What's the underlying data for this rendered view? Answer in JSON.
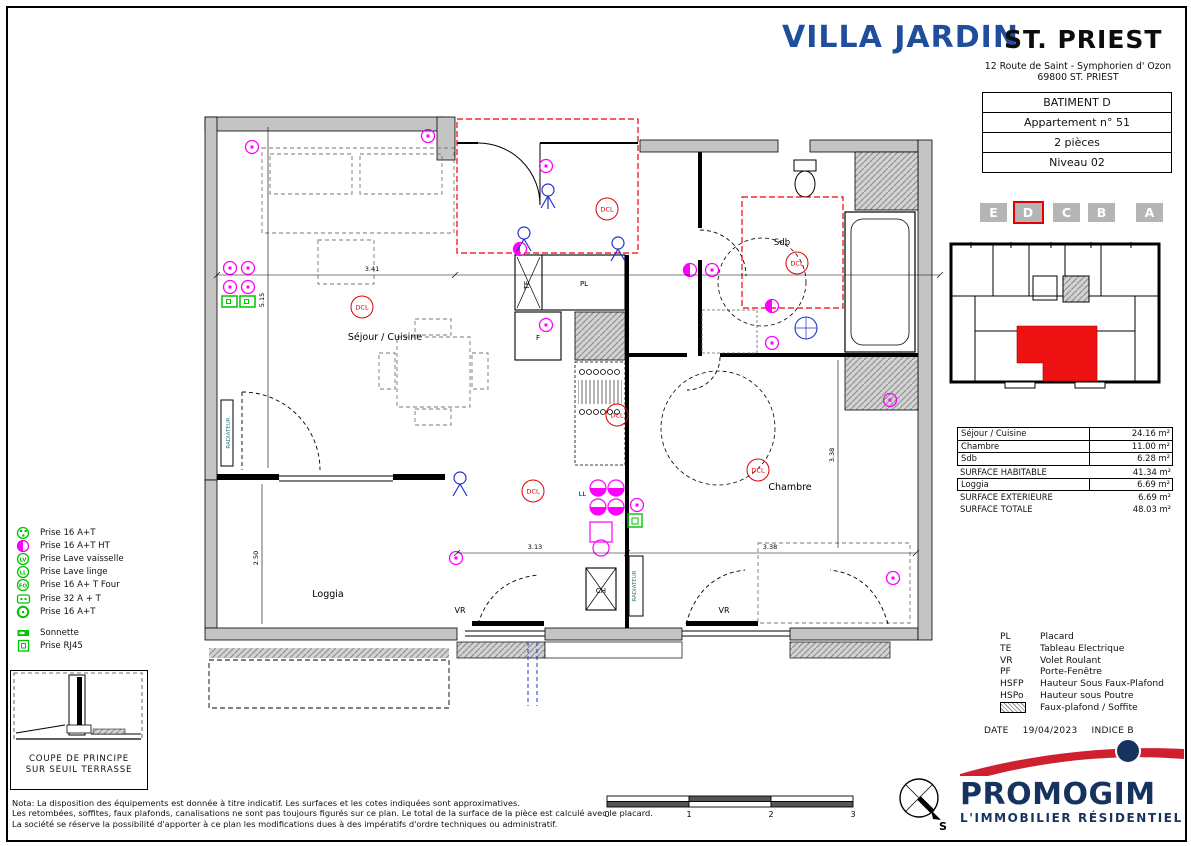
{
  "header": {
    "project_name": "VILLA JARDIN",
    "city": "ST. PRIEST",
    "address_line1": "12 Route de Saint - Symphorien d' Ozon",
    "address_line2": "69800 ST. PRIEST",
    "info_rows": [
      "BATIMENT D",
      "Appartement n° 51",
      "2 pièces",
      "Niveau 02"
    ]
  },
  "building_selector": {
    "letters": [
      "E",
      "D",
      "C",
      "B",
      "A"
    ],
    "selected": "D"
  },
  "surfaces": {
    "rows": [
      {
        "label": "Séjour / Cuisine",
        "value": "24.16 m²"
      },
      {
        "label": "Chambre",
        "value": "11.00 m²"
      },
      {
        "label": "Sdb",
        "value": "6.28 m²"
      }
    ],
    "habitable": {
      "label": "SURFACE HABITABLE",
      "value": "41.34 m²"
    },
    "loggia": {
      "label": "Loggia",
      "value": "6.69 m²"
    },
    "exterieure": {
      "label": "SURFACE EXTERIEURE",
      "value": "6.69 m²"
    },
    "totale": {
      "label": "SURFACE TOTALE",
      "value": "48.03 m²"
    }
  },
  "abbreviations": [
    {
      "abbr": "PL",
      "label": "Placard"
    },
    {
      "abbr": "TE",
      "label": "Tableau Electrique"
    },
    {
      "abbr": "VR",
      "label": "Volet Roulant"
    },
    {
      "abbr": "PF",
      "label": "Porte-Fenêtre"
    },
    {
      "abbr": "HSFP",
      "label": "Hauteur Sous Faux-Plafond"
    },
    {
      "abbr": "HSPo",
      "label": "Hauteur sous Poutre"
    },
    {
      "abbr": "",
      "label": "Faux-plafond / Soffite"
    }
  ],
  "date_block": {
    "label": "DATE",
    "date": "19/04/2023",
    "indice": "INDICE B"
  },
  "logo": {
    "name": "PROMOGIM",
    "tagline": "L'IMMOBILIER RÉSIDENTIEL"
  },
  "electrical_legend": [
    {
      "label": "Prise 16 A+T"
    },
    {
      "label": "Prise 16 A+T HT"
    },
    {
      "label": "Prise Lave vaisselle"
    },
    {
      "label": "Prise Lave linge"
    },
    {
      "label": "Prise 16 A+ T Four"
    },
    {
      "label": "Prise 32 A + T"
    },
    {
      "label": "Prise 16 A+T"
    },
    {
      "label": "Sonnette"
    },
    {
      "label": "Prise RJ45"
    }
  ],
  "coupe_box": {
    "line1": "COUPE DE PRINCIPE",
    "line2": "SUR SEUIL TERRASSE"
  },
  "nota": {
    "line1": "Nota: La disposition des équipements est donnée à titre indicatif. Les surfaces et les cotes indiquées sont approximatives.",
    "line2": "Les retombées, soffites, faux plafonds, canalisations ne sont pas toujours figurés sur ce plan. Le total de la surface de la pièce est calculé avec le placard.",
    "line3": "La société se réserve la possibilité d'apporter à ce plan les modifications dues à des impératifs d'ordre techniques ou administratif."
  },
  "scale_bar": {
    "ticks": [
      "0",
      "1",
      "2",
      "3"
    ]
  },
  "compass": {
    "label": "S"
  },
  "plan": {
    "rooms": {
      "sejour": "Séjour / Cuisine",
      "sdb": "Sdb",
      "chambre": "Chambre",
      "loggia": "Loggia"
    },
    "tags": {
      "dcl": "DCL",
      "te": "TE",
      "pl": "PL",
      "f": "F",
      "ch": "CH",
      "vr": "VR",
      "ll": "LL",
      "radiateur": "RADIATEUR"
    },
    "dims": {
      "w1": "3.41",
      "h1": "5.15",
      "h2": "2.50",
      "w2": "3.13",
      "w3": "3.38",
      "h3": "3.38"
    }
  }
}
